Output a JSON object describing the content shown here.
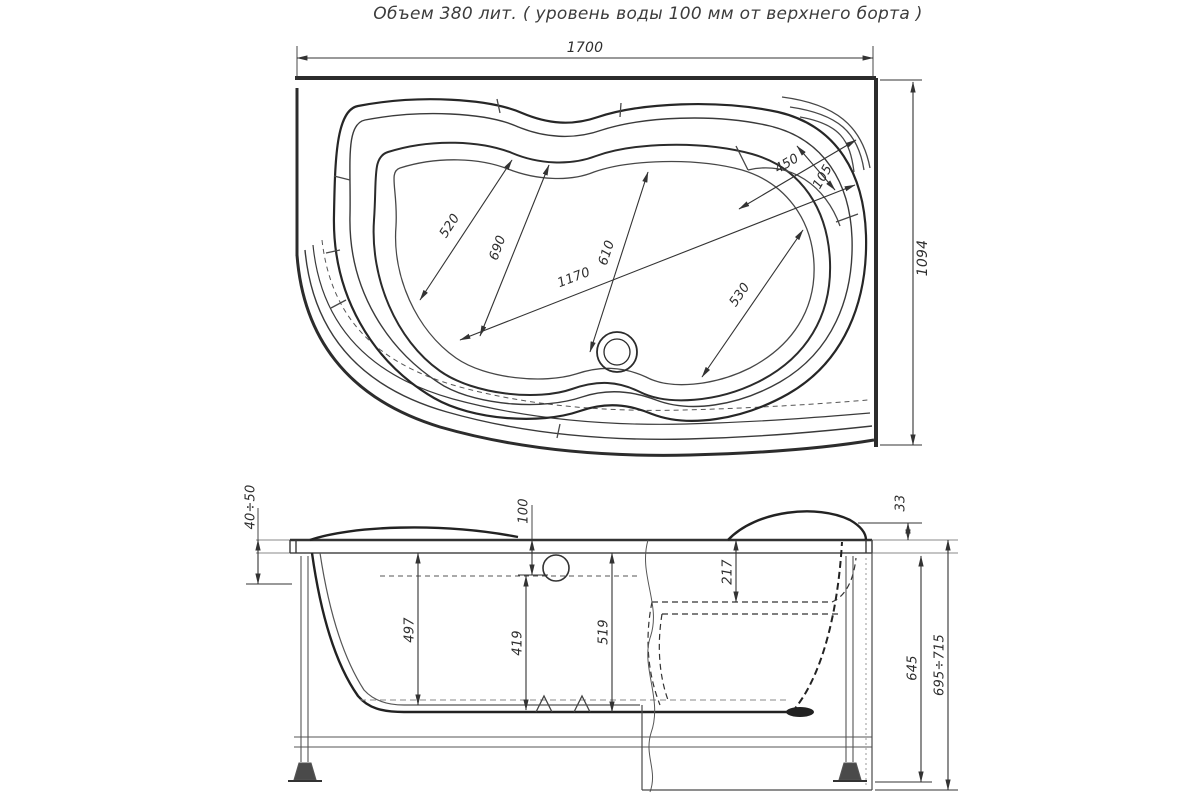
{
  "title": "Объем 380 лит. ( уровень воды 100 мм от верхнего борта )",
  "dimensions": {
    "top": {
      "overall_width": "1700",
      "overall_depth": "1094",
      "width_left": "520",
      "width_mid_left": "690",
      "basin_length": "1170",
      "width_mid": "610",
      "width_right": "530",
      "seat_width": "450",
      "seat_edge": "105"
    },
    "side": {
      "foot_adjust": "40÷50",
      "water_level_offset": "100",
      "depth_left": "497",
      "depth_center": "419",
      "depth_drain": "519",
      "seat_depth": "217",
      "rim_height": "33",
      "body_height": "645",
      "total_height": "695÷715"
    }
  }
}
